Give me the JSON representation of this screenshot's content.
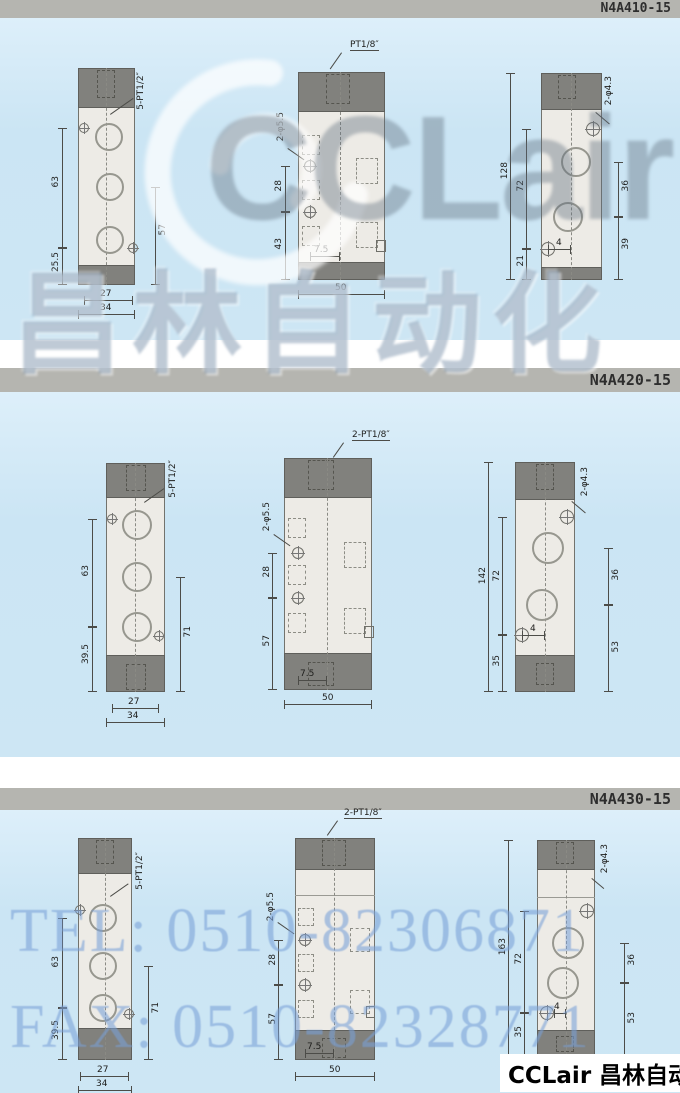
{
  "sections": [
    {
      "model": "N4A410-15",
      "front": {
        "thread_label": "5-PT1/2″",
        "dim_left": "63",
        "dim_left_bottom": "25.5",
        "dim_right": "57",
        "dim_bottom_inner": "27",
        "dim_bottom_outer": "34"
      },
      "side": {
        "port_label": "PT1/8″",
        "hole_label": "2-φ5.5",
        "dim_upper": "28",
        "dim_lower": "43",
        "dim_offset": "7.5",
        "dim_width": "50"
      },
      "back": {
        "hole_label": "2-φ4.3",
        "dim_total": "128",
        "dim_span": "72",
        "dim_bottom": "21",
        "dim_right_upper": "36",
        "dim_right_lower": "39",
        "dim_center": "4"
      }
    },
    {
      "model": "N4A420-15",
      "front": {
        "thread_label": "5-PT1/2″",
        "dim_left": "63",
        "dim_left_bottom": "39.5",
        "dim_right": "71",
        "dim_bottom_inner": "27",
        "dim_bottom_outer": "34"
      },
      "side": {
        "port_label": "2-PT1/8″",
        "hole_label": "2-φ5.5",
        "dim_upper": "28",
        "dim_lower": "57",
        "dim_offset": "7.5",
        "dim_width": "50"
      },
      "back": {
        "hole_label": "2-φ4.3",
        "dim_total": "142",
        "dim_span": "72",
        "dim_bottom": "35",
        "dim_right_upper": "36",
        "dim_right_lower": "53",
        "dim_center": "4"
      }
    },
    {
      "model": "N4A430-15",
      "front": {
        "thread_label": "5-PT1/2″",
        "dim_left": "63",
        "dim_left_bottom": "39.5",
        "dim_right": "71",
        "dim_bottom_inner": "27",
        "dim_bottom_outer": "34"
      },
      "side": {
        "port_label": "2-PT1/8″",
        "hole_label": "2-φ5.5",
        "dim_upper": "28",
        "dim_lower": "57",
        "dim_offset": "7.5",
        "dim_width": "50"
      },
      "back": {
        "hole_label": "2-φ4.3",
        "dim_total": "163",
        "dim_span": "72",
        "dim_bottom": "35",
        "dim_right_upper": "36",
        "dim_right_lower": "53",
        "dim_center": "4"
      }
    }
  ],
  "watermarks": {
    "logo": "CCLair",
    "brand_cn": "昌林自动化",
    "tel": "TEL: 0510-82306871",
    "fax": "FAX: 0510-82328771",
    "footer": "CCLair 昌林自动化"
  },
  "colors": {
    "section_bg": "#cde6f4",
    "bar_bg": "#b5b5b0",
    "cap_gray": "#81817d",
    "body_fill": "#edebe6",
    "watermark_blue": "#78a0d7"
  }
}
